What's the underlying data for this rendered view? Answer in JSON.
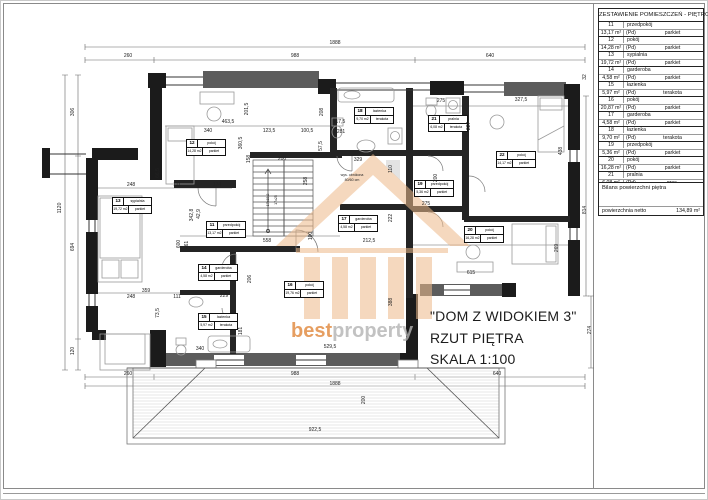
{
  "colors": {
    "accent_orange": "#e0873a",
    "logo_gray": "#b3b3b3",
    "wall_black": "#1b1b1b",
    "wall_gray": "#5c5c5c"
  },
  "title_block": {
    "line1": "\"DOM Z WIDOKIEM 3\"",
    "line2": "RZUT PIĘTRA",
    "line3": "SKALA 1:100"
  },
  "logo": {
    "best": "best",
    "property": "property"
  },
  "summary_table": {
    "title": "ZESTAWIENIE POMIESZCZEŃ - PIĘTRO",
    "rows": [
      {
        "no": "11",
        "name": "przedpokój",
        "area": "13,17 m²",
        "pd": "(Pd)",
        "finish": "parkiet"
      },
      {
        "no": "12",
        "name": "pokój",
        "area": "14,28 m²",
        "pd": "(Pd)",
        "finish": "parkiet"
      },
      {
        "no": "13",
        "name": "sypialnia",
        "area": "19,72 m²",
        "pd": "(Pd)",
        "finish": "parkiet"
      },
      {
        "no": "14",
        "name": "garderoba",
        "area": "4,58 m²",
        "pd": "(Pd)",
        "finish": "parkiet"
      },
      {
        "no": "15",
        "name": "łazienka",
        "area": "5,97 m²",
        "pd": "(Pd)",
        "finish": "terakota"
      },
      {
        "no": "16",
        "name": "pokój",
        "area": "20,87 m²",
        "pd": "(Pd)",
        "finish": "parkiet"
      },
      {
        "no": "17",
        "name": "garderoba",
        "area": "4,58 m²",
        "pd": "(Pd)",
        "finish": "parkiet"
      },
      {
        "no": "18",
        "name": "łazienka",
        "area": "9,70 m²",
        "pd": "(Pd)",
        "finish": "terakota"
      },
      {
        "no": "19",
        "name": "przedpokój",
        "area": "5,36 m²",
        "pd": "(Pd)",
        "finish": "parkiet"
      },
      {
        "no": "20",
        "name": "pokój",
        "area": "16,28 m²",
        "pd": "(Pd)",
        "finish": "parkiet"
      },
      {
        "no": "21",
        "name": "pralnia",
        "area": "6,08 m²",
        "pd": "(Pd)",
        "finish": "gres."
      },
      {
        "no": "22",
        "name": "pokój",
        "area": "14,17 m²",
        "pd": "(Pd)",
        "finish": "parkiet"
      }
    ]
  },
  "balance": {
    "title": "Bilans powierzchni piętra",
    "label": "powierzchnia netto",
    "value": "134,89 m²"
  },
  "plan": {
    "room_labels": [
      {
        "no": "11",
        "name": "przedpokój",
        "area": "13,17 m2",
        "finish": "parkiet",
        "x": 206,
        "y": 221
      },
      {
        "no": "12",
        "name": "pokój",
        "area": "14,28 m2",
        "finish": "parkiet",
        "x": 186,
        "y": 139
      },
      {
        "no": "13",
        "name": "sypialnia",
        "area": "19,72 m2",
        "finish": "parkiet",
        "x": 112,
        "y": 197
      },
      {
        "no": "14",
        "name": "garderoba",
        "area": "4,58 m2",
        "finish": "parkiet",
        "x": 198,
        "y": 264
      },
      {
        "no": "15",
        "name": "łazienka",
        "area": "5,97 m2",
        "finish": "terakota",
        "x": 198,
        "y": 313
      },
      {
        "no": "16",
        "name": "pokój",
        "area": "19,76 m2",
        "finish": "parkiet",
        "x": 284,
        "y": 281
      },
      {
        "no": "17",
        "name": "garderoba",
        "area": "4,58 m2",
        "finish": "parkiet",
        "x": 338,
        "y": 215
      },
      {
        "no": "18",
        "name": "łazienka",
        "area": "9,70 m2",
        "finish": "terakota",
        "x": 354,
        "y": 107
      },
      {
        "no": "19",
        "name": "przedpokój",
        "area": "5,36 m2",
        "finish": "parkiet",
        "x": 414,
        "y": 180
      },
      {
        "no": "20",
        "name": "pokój",
        "area": "16,28 m2",
        "finish": "parkiet",
        "x": 464,
        "y": 226
      },
      {
        "no": "21",
        "name": "pralnia",
        "area": "6,08 m2",
        "finish": "terakota",
        "x": 428,
        "y": 115
      },
      {
        "no": "22",
        "name": "pokój",
        "area": "14,17 m2",
        "finish": "parkiet",
        "x": 496,
        "y": 151
      }
    ],
    "dims": [
      {
        "t": "1888",
        "x": 335,
        "y": 43
      },
      {
        "t": "260",
        "x": 128,
        "y": 56
      },
      {
        "t": "988",
        "x": 295,
        "y": 56
      },
      {
        "t": "640",
        "x": 490,
        "y": 56
      },
      {
        "t": "1120",
        "x": 60,
        "y": 208,
        "v": 1
      },
      {
        "t": "306",
        "x": 73,
        "y": 112,
        "v": 1
      },
      {
        "t": "694",
        "x": 73,
        "y": 247,
        "v": 1
      },
      {
        "t": "120",
        "x": 73,
        "y": 351,
        "v": 1
      },
      {
        "t": "32",
        "x": 585,
        "y": 77,
        "v": 1
      },
      {
        "t": "814",
        "x": 585,
        "y": 210,
        "v": 1
      },
      {
        "t": "274",
        "x": 590,
        "y": 330,
        "v": 1
      },
      {
        "t": "260",
        "x": 128,
        "y": 374
      },
      {
        "t": "988",
        "x": 295,
        "y": 374
      },
      {
        "t": "1888",
        "x": 335,
        "y": 384
      },
      {
        "t": "640",
        "x": 497,
        "y": 374
      },
      {
        "t": "200",
        "x": 364,
        "y": 400,
        "v": 1
      },
      {
        "t": "922,5",
        "x": 315,
        "y": 430
      },
      {
        "t": "340",
        "x": 200,
        "y": 349
      },
      {
        "t": "529,5",
        "x": 330,
        "y": 347
      },
      {
        "t": "463,5",
        "x": 228,
        "y": 122
      },
      {
        "t": "340",
        "x": 208,
        "y": 131
      },
      {
        "t": "123,5",
        "x": 269,
        "y": 131
      },
      {
        "t": "100,5",
        "x": 307,
        "y": 131
      },
      {
        "t": "201,5",
        "x": 247,
        "y": 109,
        "v": 1
      },
      {
        "t": "208",
        "x": 322,
        "y": 112,
        "v": 1
      },
      {
        "t": "360,5",
        "x": 241,
        "y": 143,
        "v": 1
      },
      {
        "t": "158",
        "x": 249,
        "y": 159,
        "v": 1
      },
      {
        "t": "57,5",
        "x": 321,
        "y": 146,
        "v": 1
      },
      {
        "t": "417,5",
        "x": 339,
        "y": 122
      },
      {
        "t": "281",
        "x": 341,
        "y": 132
      },
      {
        "t": "275",
        "x": 441,
        "y": 101
      },
      {
        "t": "327,5",
        "x": 521,
        "y": 100
      },
      {
        "t": "227",
        "x": 469,
        "y": 126,
        "v": 1
      },
      {
        "t": "438",
        "x": 561,
        "y": 151,
        "v": 1
      },
      {
        "t": "329",
        "x": 358,
        "y": 160
      },
      {
        "t": "110",
        "x": 391,
        "y": 169,
        "v": 1
      },
      {
        "t": "200",
        "x": 282,
        "y": 159
      },
      {
        "t": "258",
        "x": 306,
        "y": 181,
        "v": 1
      },
      {
        "t": "100",
        "x": 311,
        "y": 236,
        "v": 1
      },
      {
        "t": "558",
        "x": 267,
        "y": 241
      },
      {
        "t": "212,5",
        "x": 369,
        "y": 241
      },
      {
        "t": "222",
        "x": 391,
        "y": 218,
        "v": 1
      },
      {
        "t": "342,8",
        "x": 192,
        "y": 215,
        "v": 1
      },
      {
        "t": "42,9",
        "x": 199,
        "y": 214,
        "v": 1
      },
      {
        "t": "248",
        "x": 131,
        "y": 185
      },
      {
        "t": "111",
        "x": 177,
        "y": 185
      },
      {
        "t": "174",
        "x": 217,
        "y": 185
      },
      {
        "t": "66,5",
        "x": 158,
        "y": 173,
        "v": 1
      },
      {
        "t": "600",
        "x": 179,
        "y": 244,
        "v": 1
      },
      {
        "t": "461",
        "x": 187,
        "y": 245,
        "v": 1
      },
      {
        "t": "359",
        "x": 146,
        "y": 291
      },
      {
        "t": "248",
        "x": 131,
        "y": 297
      },
      {
        "t": "111",
        "x": 177,
        "y": 297
      },
      {
        "t": "73,5",
        "x": 158,
        "y": 313,
        "v": 1
      },
      {
        "t": "206",
        "x": 250,
        "y": 279,
        "v": 1
      },
      {
        "t": "229",
        "x": 224,
        "y": 296
      },
      {
        "t": "181",
        "x": 241,
        "y": 331,
        "v": 1
      },
      {
        "t": "275",
        "x": 426,
        "y": 204
      },
      {
        "t": "615",
        "x": 471,
        "y": 273
      },
      {
        "t": "388",
        "x": 391,
        "y": 302,
        "v": 1
      },
      {
        "t": "269",
        "x": 557,
        "y": 248,
        "v": 1
      },
      {
        "t": "200",
        "x": 436,
        "y": 178,
        "v": 1
      }
    ],
    "notes": [
      {
        "t": "wys. obniżona",
        "x": 352,
        "y": 175
      },
      {
        "t": "80/60 cm",
        "x": 352,
        "y": 180
      },
      {
        "t": "17x18,2",
        "x": 268,
        "y": 200,
        "v": 1
      },
      {
        "t": "17x25",
        "x": 276,
        "y": 200,
        "v": 1
      }
    ]
  }
}
